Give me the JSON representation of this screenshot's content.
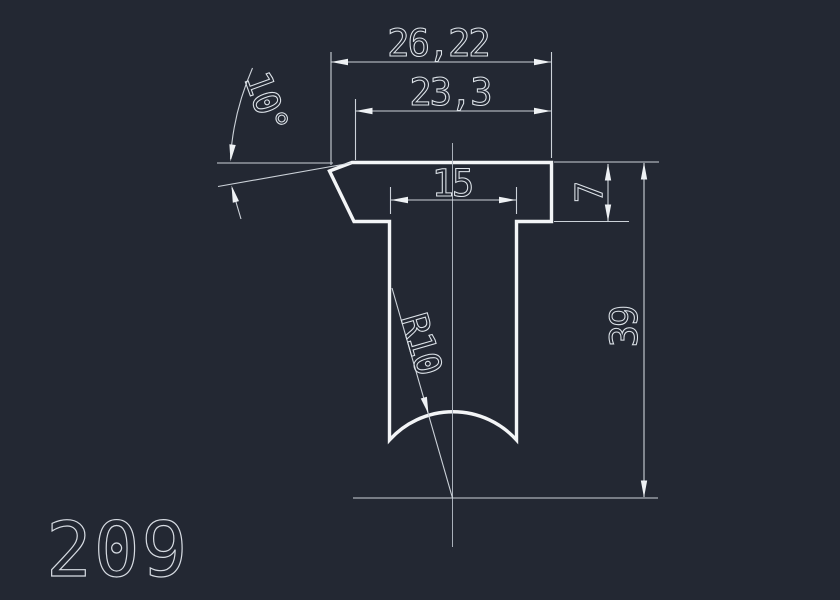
{
  "part_label": "209",
  "colors": {
    "background": "#232833",
    "profile_stroke": "#f3f5f7",
    "dimension_stroke": "#ccd2d9",
    "centerline_stroke": "#a9b0ba"
  },
  "dimensions": {
    "overall_width": "26,22",
    "upper_face_width": "23,3",
    "stem_width": "15",
    "flange_thickness": "7",
    "overall_height": "39",
    "bottom_radius": "R10",
    "chamfer_angle": "10°"
  }
}
